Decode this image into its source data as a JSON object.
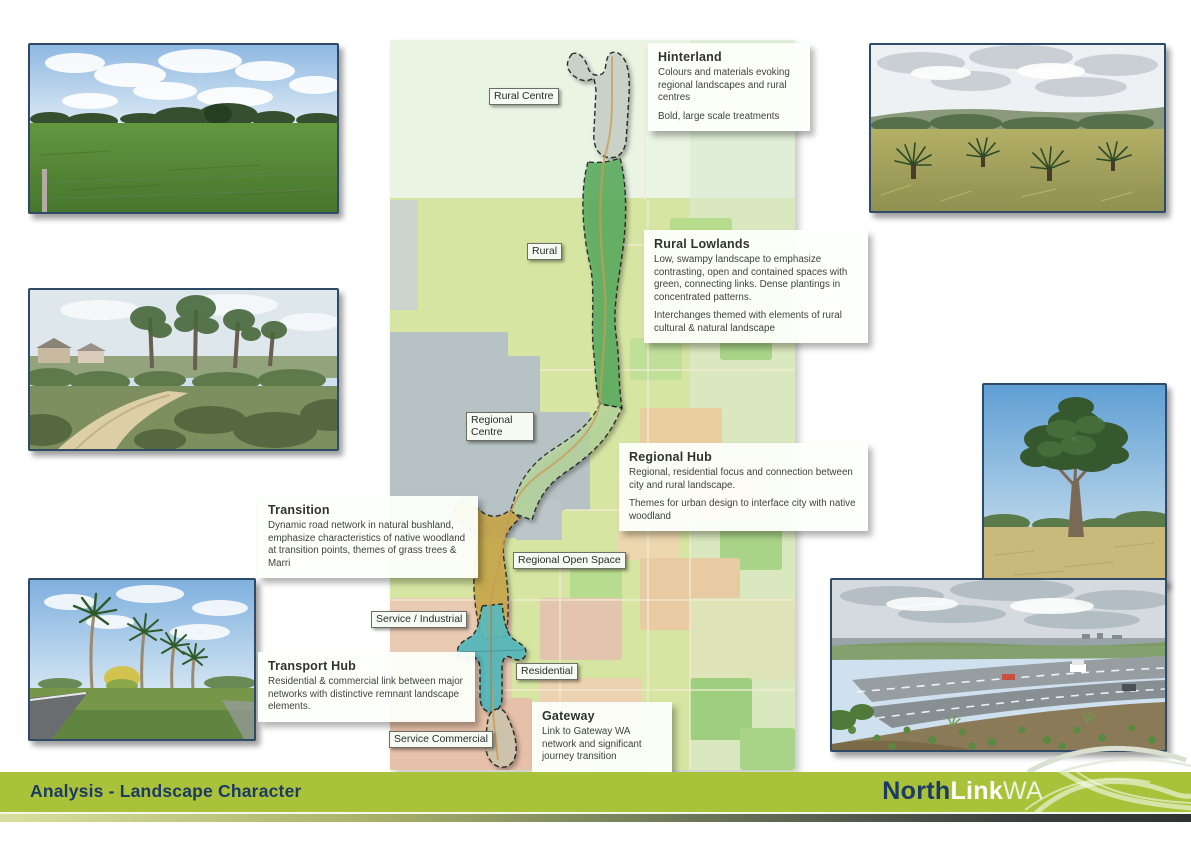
{
  "footer": {
    "title": "Analysis - Landscape Character",
    "logo": {
      "part1": "North",
      "part2": "Link",
      "part3": "WA"
    }
  },
  "map": {
    "labels": {
      "rural_centre": "Rural Centre",
      "rural": "Rural",
      "regional_centre": "Regional Centre",
      "regional_open_space": "Regional Open Space",
      "service_industrial": "Service / Industrial",
      "residential": "Residential",
      "service_commercial": "Service Commercial"
    }
  },
  "callouts": [
    {
      "title": "Hinterland",
      "p1": "Colours and materials evoking regional landscapes and rural centres",
      "p2": "Bold, large scale treatments"
    },
    {
      "title": "Rural Lowlands",
      "p1": "Low, swampy landscape to emphasize contrasting, open and contained spaces with green, connecting links. Dense plantings in concentrated patterns.",
      "p2": "Interchanges themed with elements of rural cultural & natural landscape"
    },
    {
      "title": "Regional Hub",
      "p1": "Regional, residential focus and connection between city and rural landscape.",
      "p2": "Themes for urban design to interface city with native woodland"
    },
    {
      "title": "Transition",
      "p1": "Dynamic road network in natural bushland, emphasize characteristics of native woodland at transition points, themes of grass trees & Marri"
    },
    {
      "title": "Transport Hub",
      "p1": "Residential & commercial link between major networks with distinctive remnant landscape elements."
    },
    {
      "title": "Gateway",
      "p1": "Link to Gateway WA network and significant journey transition"
    }
  ],
  "photos": [
    {
      "id": "rural-pasture"
    },
    {
      "id": "bushland-track"
    },
    {
      "id": "palm-lined-road"
    },
    {
      "id": "grass-trees-paddock"
    },
    {
      "id": "large-marri-tree"
    },
    {
      "id": "highway-revegetation"
    }
  ],
  "colors": {
    "footer_green": "#a9c23a",
    "footer_navy": "#1c3a64",
    "zone_hinterland": "#c9d3c7",
    "zone_rural_lowlands": "#5fae62",
    "zone_regional_hub": "#b8d79e",
    "zone_transition": "#c8a84b",
    "zone_transport_hub": "#55b9bb",
    "zone_gateway": "#cfc5ad"
  }
}
